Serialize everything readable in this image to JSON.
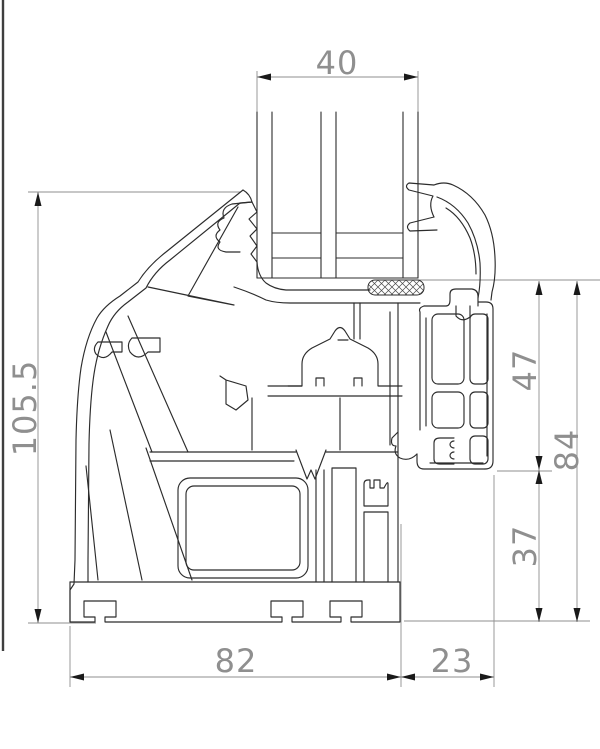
{
  "page": {
    "background": "#ffffff",
    "type": "technical cross-section drawing",
    "subject": "PVC window sash and frame profile with triple glazing"
  },
  "drawing": {
    "line_color": "#2c2c2c",
    "dimension_color": "#8f8f8f",
    "arrow_color": "#1a1a1a",
    "hatch_color": "#4a4a4a",
    "glazing_pane_count": 3,
    "dimensions": {
      "top": "40",
      "left": "105.5",
      "right_upper": "47",
      "right_overall": "84",
      "right_lower": "37",
      "bottom_left": "82",
      "bottom_right": "23"
    }
  }
}
